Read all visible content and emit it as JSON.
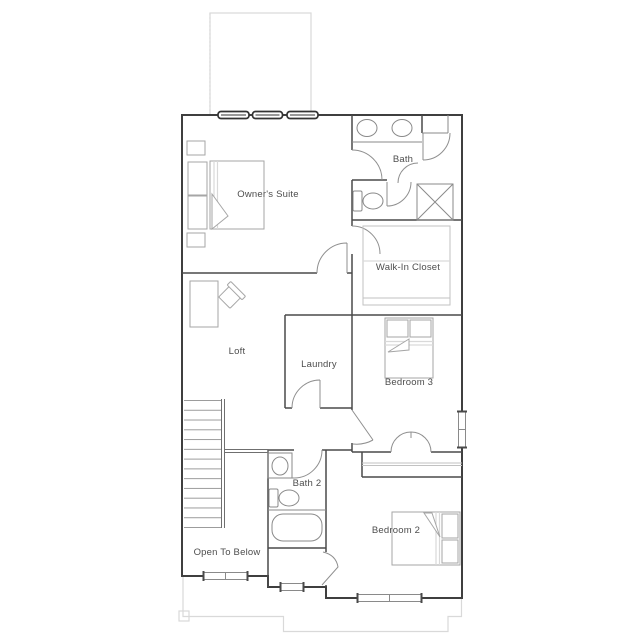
{
  "rooms": [
    {
      "name": "owners-suite",
      "label": "Owner's Suite"
    },
    {
      "name": "bath",
      "label": "Bath"
    },
    {
      "name": "walk-in-closet",
      "label": "Walk-In Closet"
    },
    {
      "name": "loft",
      "label": "Loft"
    },
    {
      "name": "laundry",
      "label": "Laundry"
    },
    {
      "name": "bedroom-3",
      "label": "Bedroom 3"
    },
    {
      "name": "bath-2",
      "label": "Bath 2"
    },
    {
      "name": "bedroom-2",
      "label": "Bedroom 2"
    },
    {
      "name": "open-to-below",
      "label": "Open To Below"
    }
  ],
  "fixtures": [
    "double-sink-vanity",
    "toilet",
    "shower-stall",
    "linen-closet",
    "walk-in-closet-shelving",
    "bed",
    "nightstand",
    "pillow",
    "desk",
    "chair",
    "stairs",
    "railing",
    "single-sink-vanity",
    "bathtub",
    "closet-shelf",
    "window",
    "door-swing"
  ],
  "colors": {
    "exterior_wall": "#3f3f3f",
    "interior_wall": "#4a4a4a",
    "fixture": "#8a8a8a",
    "furniture": "#a6a6a6",
    "light_outline": "#d9d9d9",
    "window_frame": "#333333",
    "label_text": "#4d4d4d",
    "background": "#ffffff"
  }
}
